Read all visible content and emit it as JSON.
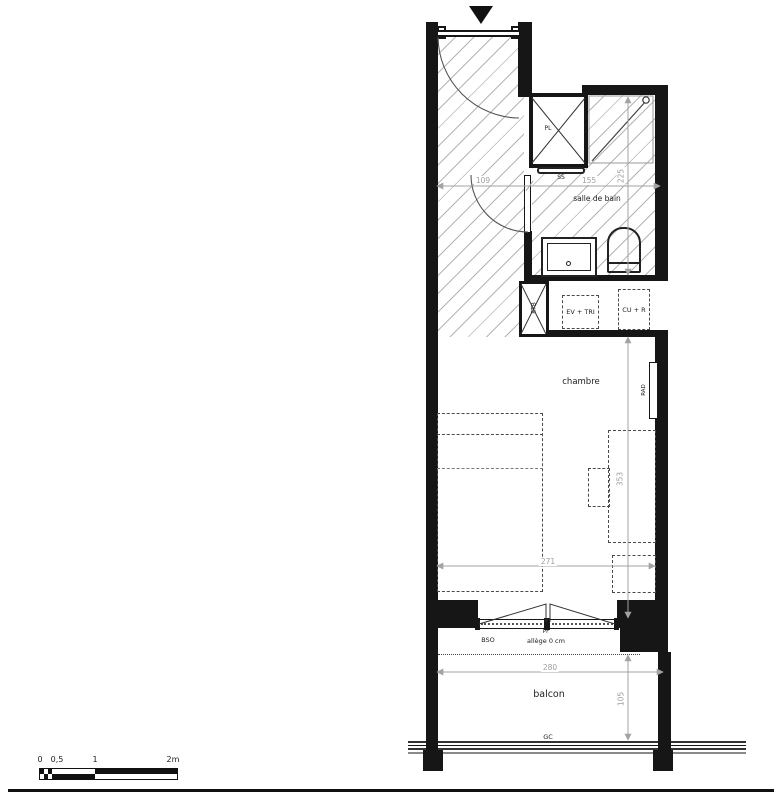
{
  "plan": {
    "rooms": {
      "bathroom": "salle de bain",
      "bedroom": "chambre",
      "balcony": "balcon"
    },
    "annotations": {
      "closet": "PL",
      "towel_rail": "SS",
      "duct": "ETB",
      "sink_sorting": "EV + TRI",
      "cooker_fridge": "CU + R",
      "radiator": "RAD",
      "blind": "BSO",
      "french_window": "PF",
      "sill": "allège 0 cm",
      "guardrail": "GC"
    },
    "dimensions_cm": {
      "entry_width": "109",
      "bathroom_width": "155",
      "bathroom_depth": "225",
      "bedroom_width": "271",
      "bedroom_depth": "353",
      "balcony_width": "280",
      "balcony_depth": "105"
    },
    "scale_bar": {
      "tick_0": "0",
      "tick_05": "0,5",
      "tick_1": "1",
      "tick_2": "2m"
    },
    "colors": {
      "wall": "#161616",
      "hatch_line": "#b5b5b5",
      "dimension": "#9e9e9e"
    }
  }
}
